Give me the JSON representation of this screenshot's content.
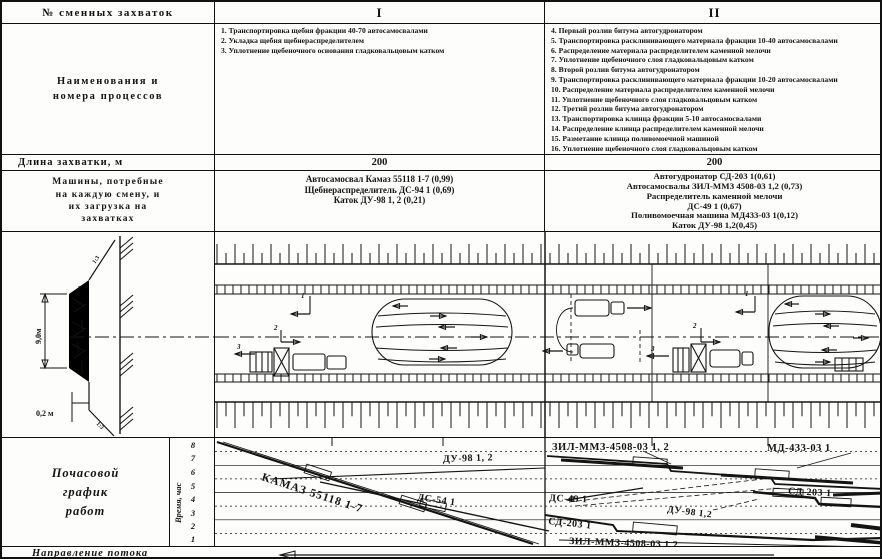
{
  "header": {
    "zahvatki_label": "№ сменных захваток",
    "col1": "I",
    "col2": "II"
  },
  "processes": {
    "row_label_line1": "Наименования и",
    "row_label_line2": "номера  процессов",
    "section1": [
      "1. Транспортировка щебня фракции 40-70 автосамосвалами",
      "2. Укладка щебня щебнераспределителем",
      "3. Уплотнение щебеночного основания гладковальцовым катком"
    ],
    "section2": [
      "4. Первый розлив битума автогудронатором",
      "5. Транспортировка расклинивающего материала фракции 10-40 автосамосвалами",
      "6. Распределение материала распределителем каменной мелочи",
      "7. Уплотнение щебеночного слоя гладковальцовым катком",
      "8. Второй розлив битума автогудронатором",
      "9. Транспортировка расклинивающего материала фракции 10-20 автосамосвалами",
      "10. Распределение материала распределителем каменной мелочи",
      "11. Уплотнение щебеночного слоя гладковальцовым катком",
      "12. Третий розлив битума автогудронатором",
      "13. Транспортировка клинца фракции 5-10 автосамосвалами",
      "14. Распределение клинца распределителем каменной мелочи",
      "15. Разметание клинца поливомоечной машиной",
      "16. Уплотнение щебеночного слоя гладковальцовым катком"
    ]
  },
  "length_row": {
    "label": "Длина захватки, м",
    "section1": "200",
    "section2": "200"
  },
  "machines_row": {
    "label_lines": [
      "Машины, потребные",
      "на каждую смену, и",
      "их загрузка на",
      "захватках"
    ],
    "section1": [
      "Автосамосвал Камаз 55118 1-7 (0,99)",
      "Щебнераспределитель ДС-94 1 (0,69)",
      "Каток ДУ-98 1, 2 (0,21)"
    ],
    "section2": [
      "Автогудронатор СД-203 1(0,61)",
      "Автосамосвалы ЗИЛ-ММЗ 4508-03 1,2 (0,73)",
      "Распределитель каменной мелочи",
      "ДС-49 1 (0,67)",
      "Поливомоечная машина МД433-03 1(0,12)",
      "Каток ДУ-98 1,2(0,45)"
    ]
  },
  "plan": {
    "road_width": "9,0м",
    "shoulder": "0,2 м",
    "slope_top": "1:3",
    "slope_bottom": "1:3",
    "arrows": [
      "1",
      "2",
      "3"
    ]
  },
  "schedule": {
    "row_label_lines": [
      "Почасовой",
      "график",
      "работ"
    ],
    "axis_label": "Время, час",
    "hours": [
      "8",
      "7",
      "6",
      "5",
      "4",
      "3",
      "2",
      "1"
    ],
    "labels": {
      "kamaz": "КАМАЗ 55118 1-7",
      "du98_I": "ДУ-98  1, 2",
      "ds54": "ДС-54 1",
      "zil_top": "ЗИЛ-ММЗ-4508-03  1, 2",
      "md433": "МД-433-03  1",
      "ds49": "ДС-49  1",
      "sd203_right": "СД-203  1",
      "du98_II": "ДУ-98  1,2",
      "sd203_left": "СД-203  1",
      "zil_bottom": "ЗИЛ-ММЗ-4508-03  1,2"
    }
  },
  "footer": {
    "label": "Направление потока"
  }
}
